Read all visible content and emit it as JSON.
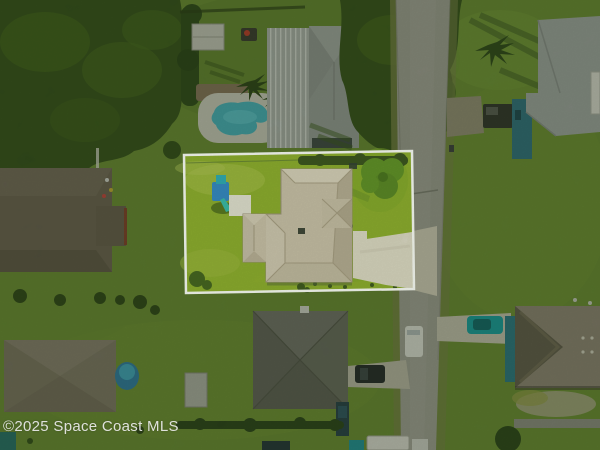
{
  "photo": {
    "alt": "Aerial drone view of a residential neighborhood; subject property outlined in white",
    "watermark": "©2025 Space Coast MLS"
  },
  "colors": {
    "lawn": "#6d9038",
    "lawn_subject": "#8cab2d",
    "canopy": "#36521f",
    "road": "#a6a59e",
    "driveway": "#ddd8c9",
    "roof_subject": "#c9beac",
    "roof_gray": "#9da2a3",
    "roof_metal": "#b0b6b6",
    "roof_dark": "#6b6c64",
    "roof_brown": "#93897b",
    "roof_left": "#6e6358",
    "roof_bottomleft": "#827a6d",
    "pool": "#48b7c9",
    "pool_deck": "#d2d1c8",
    "car_teal": "#16a3a9",
    "car_white": "#e8e8e4",
    "car_dark": "#23282c",
    "playset": "#2f86c8",
    "slide": "#35b9ab",
    "boundary": "#ffffff",
    "watermark_color": "#ebebeb"
  }
}
